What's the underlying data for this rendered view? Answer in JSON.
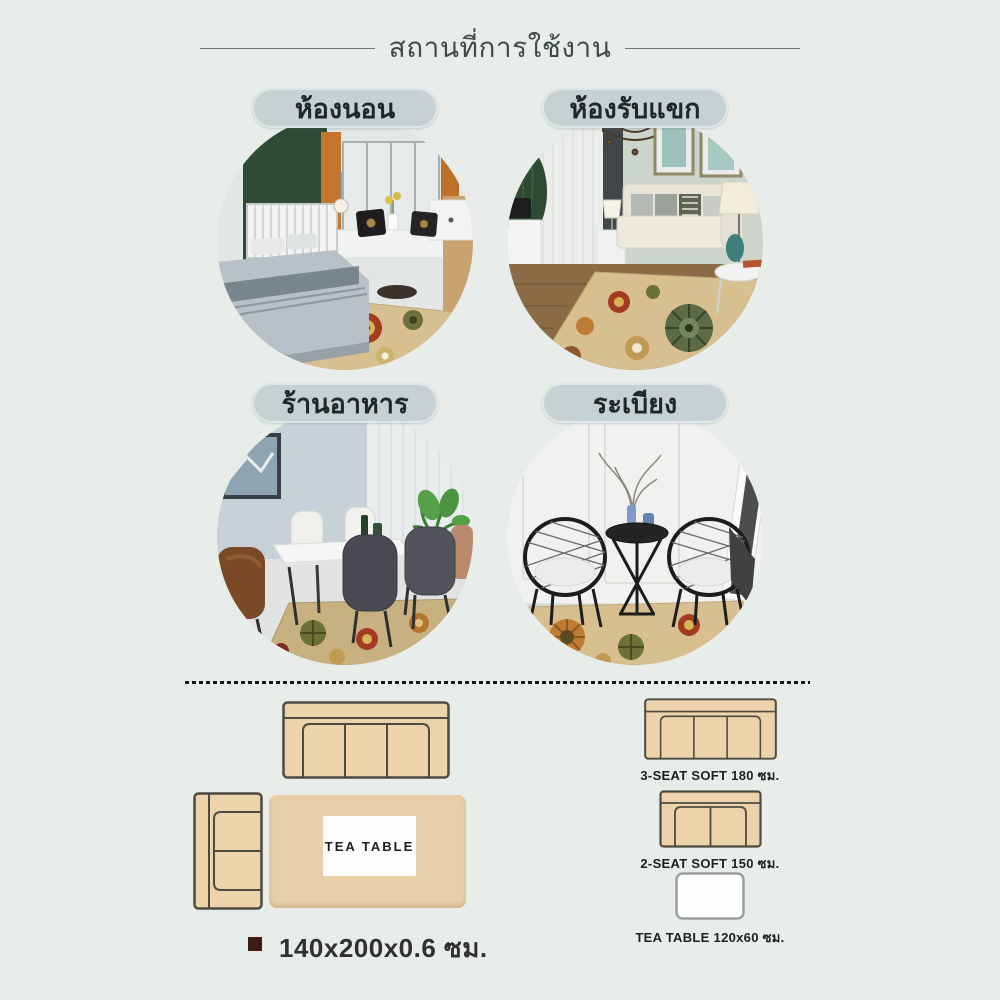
{
  "header": {
    "title": "สถานที่การใช้งาน"
  },
  "rooms": [
    {
      "label": "ห้องนอน",
      "scene": "bedroom"
    },
    {
      "label": "ห้องรับแขก",
      "scene": "living-room"
    },
    {
      "label": "ร้านอาหาร",
      "scene": "restaurant"
    },
    {
      "label": "ระเบียง",
      "scene": "balcony"
    }
  ],
  "layout_diagram": {
    "tea_table_label": "TEA TABLE",
    "size_caption": "140x200x0.6 ซม."
  },
  "furniture_legend": [
    {
      "type": "sofa-3",
      "label": "3-SEAT SOFT 180 ซม."
    },
    {
      "type": "sofa-2",
      "label": "2-SEAT SOFT 150 ซม."
    },
    {
      "type": "tea-table",
      "label": "TEA TABLE 120x60 ซม."
    }
  ],
  "colors": {
    "background": "#e8ede9",
    "pill": "#c6d1d3",
    "title_text": "#3f4b4b",
    "sofa_fill": "#ecd3ab",
    "sofa_outline": "#4d4b40",
    "rug_tan": "#e9cfa9",
    "bullet": "#3a1d10"
  }
}
